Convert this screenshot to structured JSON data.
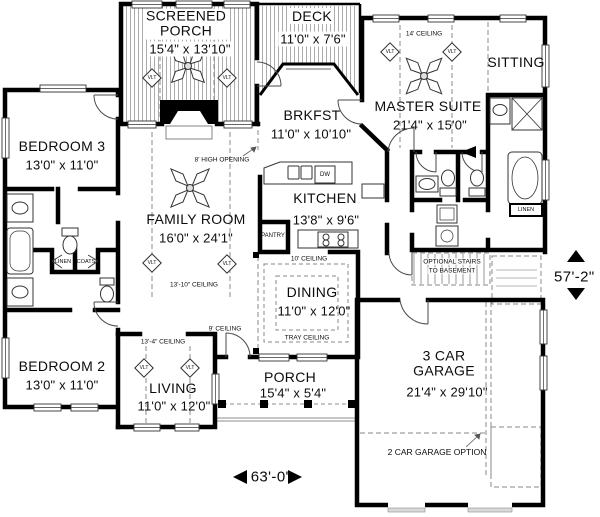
{
  "labels": {
    "vlt": "VLT",
    "dw": "DW",
    "pantry": "PANTRY",
    "linen_left": "LINEN",
    "coats": "COATS",
    "linen_right": "LINEN"
  },
  "rooms": {
    "screened_porch": {
      "name": "SCREENED PORCH",
      "dims": "15'4\" x 13'10\""
    },
    "deck": {
      "name": "DECK",
      "dims": "11'0\" x 7'6\""
    },
    "master_suite": {
      "name": "MASTER SUITE",
      "dims": "21'4\" x 15'0\""
    },
    "sitting": {
      "name": "SITTING"
    },
    "brkfst": {
      "name": "BRKFST",
      "dims": "11'0\" x 10'10\""
    },
    "bedroom3": {
      "name": "BEDROOM 3",
      "dims": "13'0\" x 11'0\""
    },
    "family_room": {
      "name": "FAMILY ROOM",
      "dims": "16'0\" x 24'1\""
    },
    "kitchen": {
      "name": "KITCHEN",
      "dims": "13'8\" x 9'6\""
    },
    "dining": {
      "name": "DINING",
      "dims": "11'0\" x 12'0\""
    },
    "bedroom2": {
      "name": "BEDROOM 2",
      "dims": "13'0\" x 11'0\""
    },
    "living": {
      "name": "LIVING",
      "dims": "11'0\" x 12'0\""
    },
    "porch": {
      "name": "PORCH",
      "dims": "15'4\" x 5'4\""
    },
    "garage": {
      "name": "3 CAR GARAGE",
      "dims": "21'4\" x 29'10\""
    }
  },
  "notes": {
    "ceiling_14": "14' CEILING",
    "high_opening": "8' HIGH OPENING",
    "ceiling_13_10": "13'-10\" CEILING",
    "ceiling_10": "10' CEILING",
    "tray_ceiling": "TRAY CEILING",
    "ceiling_13_4": "13'-4\" CEILING",
    "ceiling_9": "9' CEILING",
    "stairs_line1": "OPTIONAL STAIRS",
    "stairs_line2": "TO BASEMENT",
    "garage_option": "2 CAR GARAGE OPTION"
  },
  "dimensions": {
    "width": "63'-0\"",
    "height": "57'-2\""
  },
  "colors": {
    "wall": "#000000",
    "hatch": "#ababab",
    "dashed": "#8a8a8a"
  }
}
